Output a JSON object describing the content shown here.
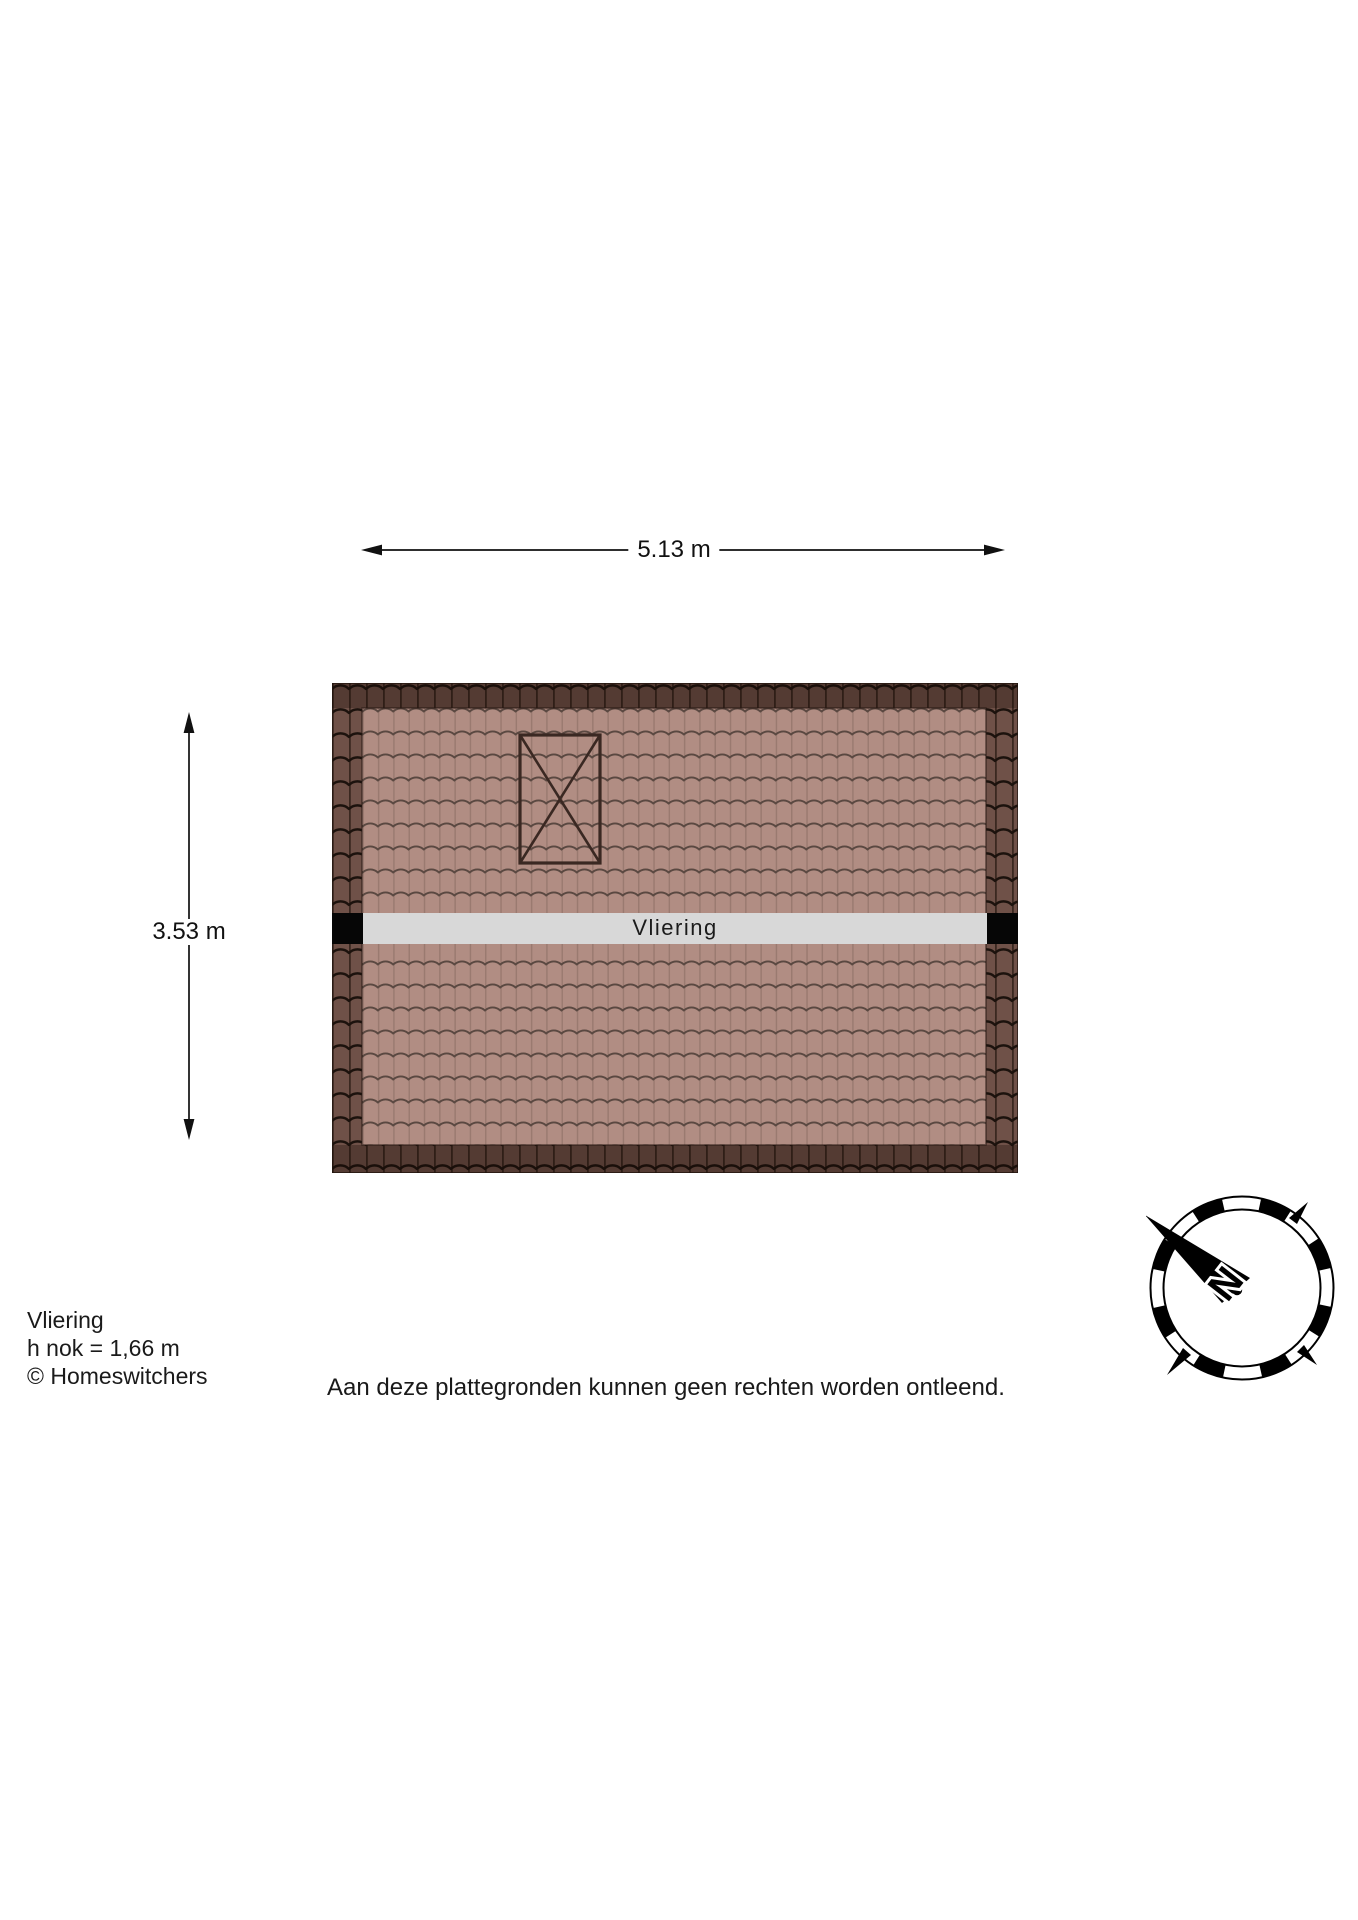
{
  "floorplan": {
    "room_label": "Vliering",
    "width_label": "5.13 m",
    "height_label": "3.53 m"
  },
  "footer": {
    "title": "Vliering",
    "ridge_height": "h nok = 1,66 m",
    "copyright": "© Homeswitchers",
    "disclaimer": "Aan deze plattegronden kunnen geen rechten worden ontleend."
  },
  "compass": {
    "north_label": "N"
  },
  "icons": {
    "skylight": "crossed-box-hatch-icon",
    "compass": "compass-rose-icon"
  },
  "colors": {
    "tile-light": "#b18d83",
    "tile-light-line": "#9a7a70",
    "tile-scallop-light": "#5a4841",
    "tile-dark": "#6f5148",
    "tile-dark-line": "#3a2820",
    "tile-scallop-dark": "#1c120d",
    "band": "#d8d8d8",
    "band-cap": "#060606",
    "skylight": "#3a2822",
    "line": "#111111",
    "text": "#1a1a1a"
  }
}
